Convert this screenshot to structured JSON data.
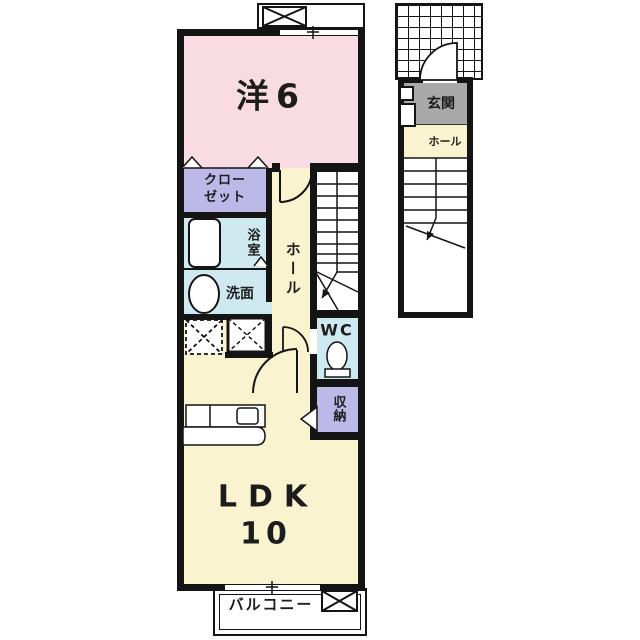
{
  "labels": {
    "bedroom": "洋6",
    "closet": "クロー\nゼット",
    "bath": "浴室",
    "washroom": "洗面",
    "hall": "ホール",
    "wc": "WC",
    "storage": "収納",
    "ldk": "LDK",
    "ldk_size": "10",
    "balcony": "バルコニー",
    "entrance": "玄関",
    "entrance_hall": "ホール"
  },
  "colors": {
    "bedroom_pink": "#f9dbe3",
    "living_cream": "#faf3cf",
    "wet_area_blue": "#cfe9f1",
    "closet_lavender": "#bcb8e8",
    "entrance_gray": "#a9a9a9",
    "wall_black": "#141414",
    "background": "#ffffff"
  }
}
